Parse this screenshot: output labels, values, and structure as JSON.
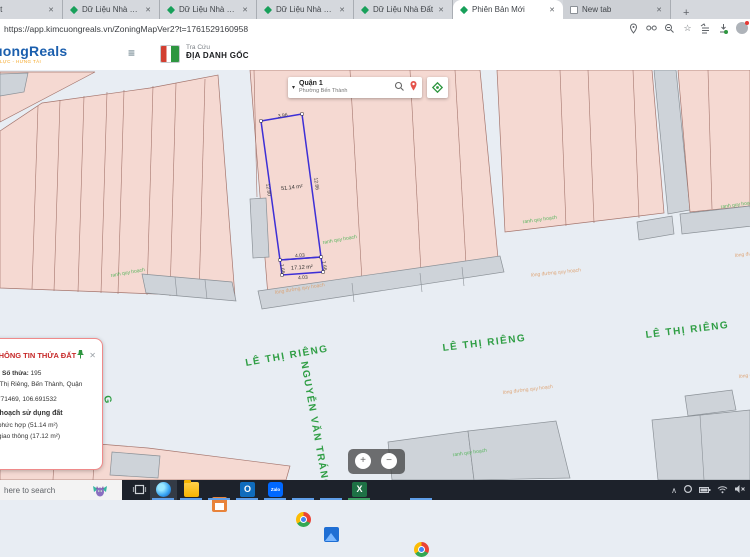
{
  "browser": {
    "tabs": [
      {
        "label": "Nhà Đất"
      },
      {
        "label": "Dữ Liệu Nhà Đất"
      },
      {
        "label": "Dữ Liệu Nhà Đất"
      },
      {
        "label": "Dữ Liệu Nhà Đất"
      },
      {
        "label": "Dữ Liệu Nhà Đất"
      },
      {
        "label": "Phiên Bản Mới"
      },
      {
        "label": "New tab"
      }
    ],
    "close_glyph": "✕",
    "new_tab_glyph": "+",
    "url": "https://app.kimcuongreals.vn/ZoningMapVer2?t=1761529160958",
    "star_glyph": "☆"
  },
  "header": {
    "logo": "uongReals",
    "tagline": "LỰC - HƯNG TÀI",
    "menu_glyph": "≡",
    "lookup_label": "Tra Cứu",
    "lookup_title": "ĐỊA DANH GỐC"
  },
  "search": {
    "caret": "▾",
    "district": "Quận 1",
    "ward": "Phường Bến Thành"
  },
  "map": {
    "streets": {
      "le_thi_rieng": "LÊ THỊ RIÊNG",
      "nguyen_van_trang": "NGUYỄN VĂN TRÁNG",
      "fragment_g": "G"
    },
    "overlay_labels": {
      "ranh_quy_hoach": "ranh quy hoạch",
      "long_duong_quy_hoach": "lòng đường quy hoạch"
    },
    "parcel": {
      "area_main": "51.14 m²",
      "area_road": "17.12 m²",
      "dim_top": "3.96",
      "dim_left": "12.80",
      "dim_right": "12.86",
      "dim_inner": "4.03",
      "dim_bottom": "4.03",
      "dim_side_right": "1.66",
      "dim_side_left": "1.66"
    },
    "zoom_in": "+",
    "zoom_out": "−"
  },
  "info_panel": {
    "title": "THÔNG TIN THỬA ĐẤT",
    "close_glyph": "✕",
    "so_thua_label": "Số thửa:",
    "so_thua_value": " 195",
    "address": "70, Lê Thị Riêng, Bến Thành, Quận",
    "coords": "10.771469, 106.691532",
    "section_title": "Quy hoạch sử dụng đất",
    "usage_1": "Đất phức hợp (51.14 m²)",
    "usage_2": "Đất giao thông (17.12 m²)"
  },
  "taskbar": {
    "search_text": "here to search",
    "outlook_letter": "O",
    "zalo_text": "Zalo",
    "excel_letter": "X",
    "chevron_up": "∧"
  }
}
